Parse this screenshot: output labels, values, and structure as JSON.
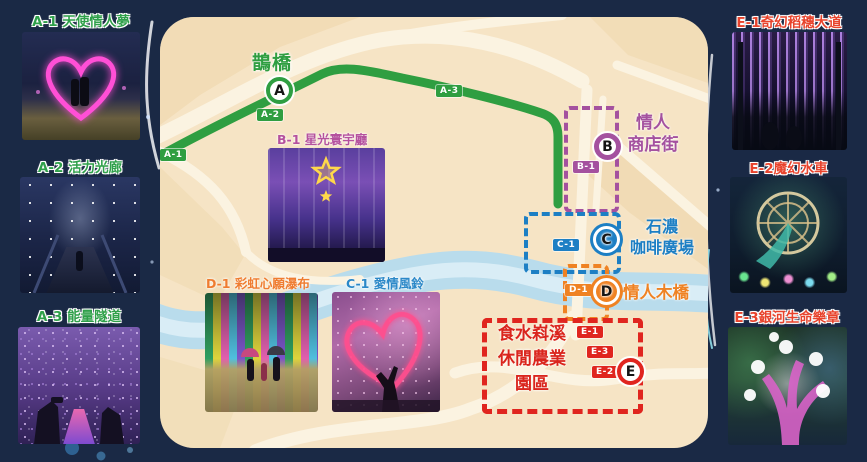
{
  "colors": {
    "background": "#1a2945",
    "map_fill": "#f6e4c5",
    "road": "#fbf3e1",
    "river": "#b9dcec",
    "route_green": "#2f9e41",
    "purple": "#a4519f",
    "blue": "#1d7fc4",
    "orange": "#ef8223",
    "red": "#e0251f",
    "left_label_green": "#2fa04a",
    "right_label_red": "#e8432c"
  },
  "left_column": {
    "items": [
      {
        "label": "A-1 天使情人夢"
      },
      {
        "label": "A-2 活力光廊"
      },
      {
        "label": "A-3 能量隧道"
      }
    ]
  },
  "right_column": {
    "items": [
      {
        "label": "E-1奇幻稻穗大道"
      },
      {
        "label": "E-2魔幻水車"
      },
      {
        "label": "E-3銀河生命樂章"
      }
    ]
  },
  "map": {
    "bridge_label": "鵲橋",
    "route_badges": {
      "a1": "A-1",
      "a2": "A-2",
      "a3": "A-3"
    },
    "markers": {
      "a": "A",
      "b": "B",
      "c": "C",
      "d": "D",
      "e": "E"
    },
    "photo_labels": {
      "b1": "B-1 星光寰宇廳",
      "d1": "D-1 彩虹心願瀑布",
      "c1": "C-1 愛情風鈴"
    },
    "spot_badges": {
      "b1": "B-1",
      "c1": "C-1",
      "d1": "D-1",
      "e1": "E-1",
      "e2": "E-2",
      "e3": "E-3"
    },
    "areas": {
      "shop_street": {
        "line1": "情人",
        "line2": "商店街"
      },
      "coffee_plaza": {
        "line1": "石濃",
        "line2": "咖啡廣場"
      },
      "wooden_bridge": "情人木橋",
      "farm_zone": {
        "line1": "食水嵙溪",
        "line2": "休閒農業",
        "line3": "園區"
      }
    }
  }
}
